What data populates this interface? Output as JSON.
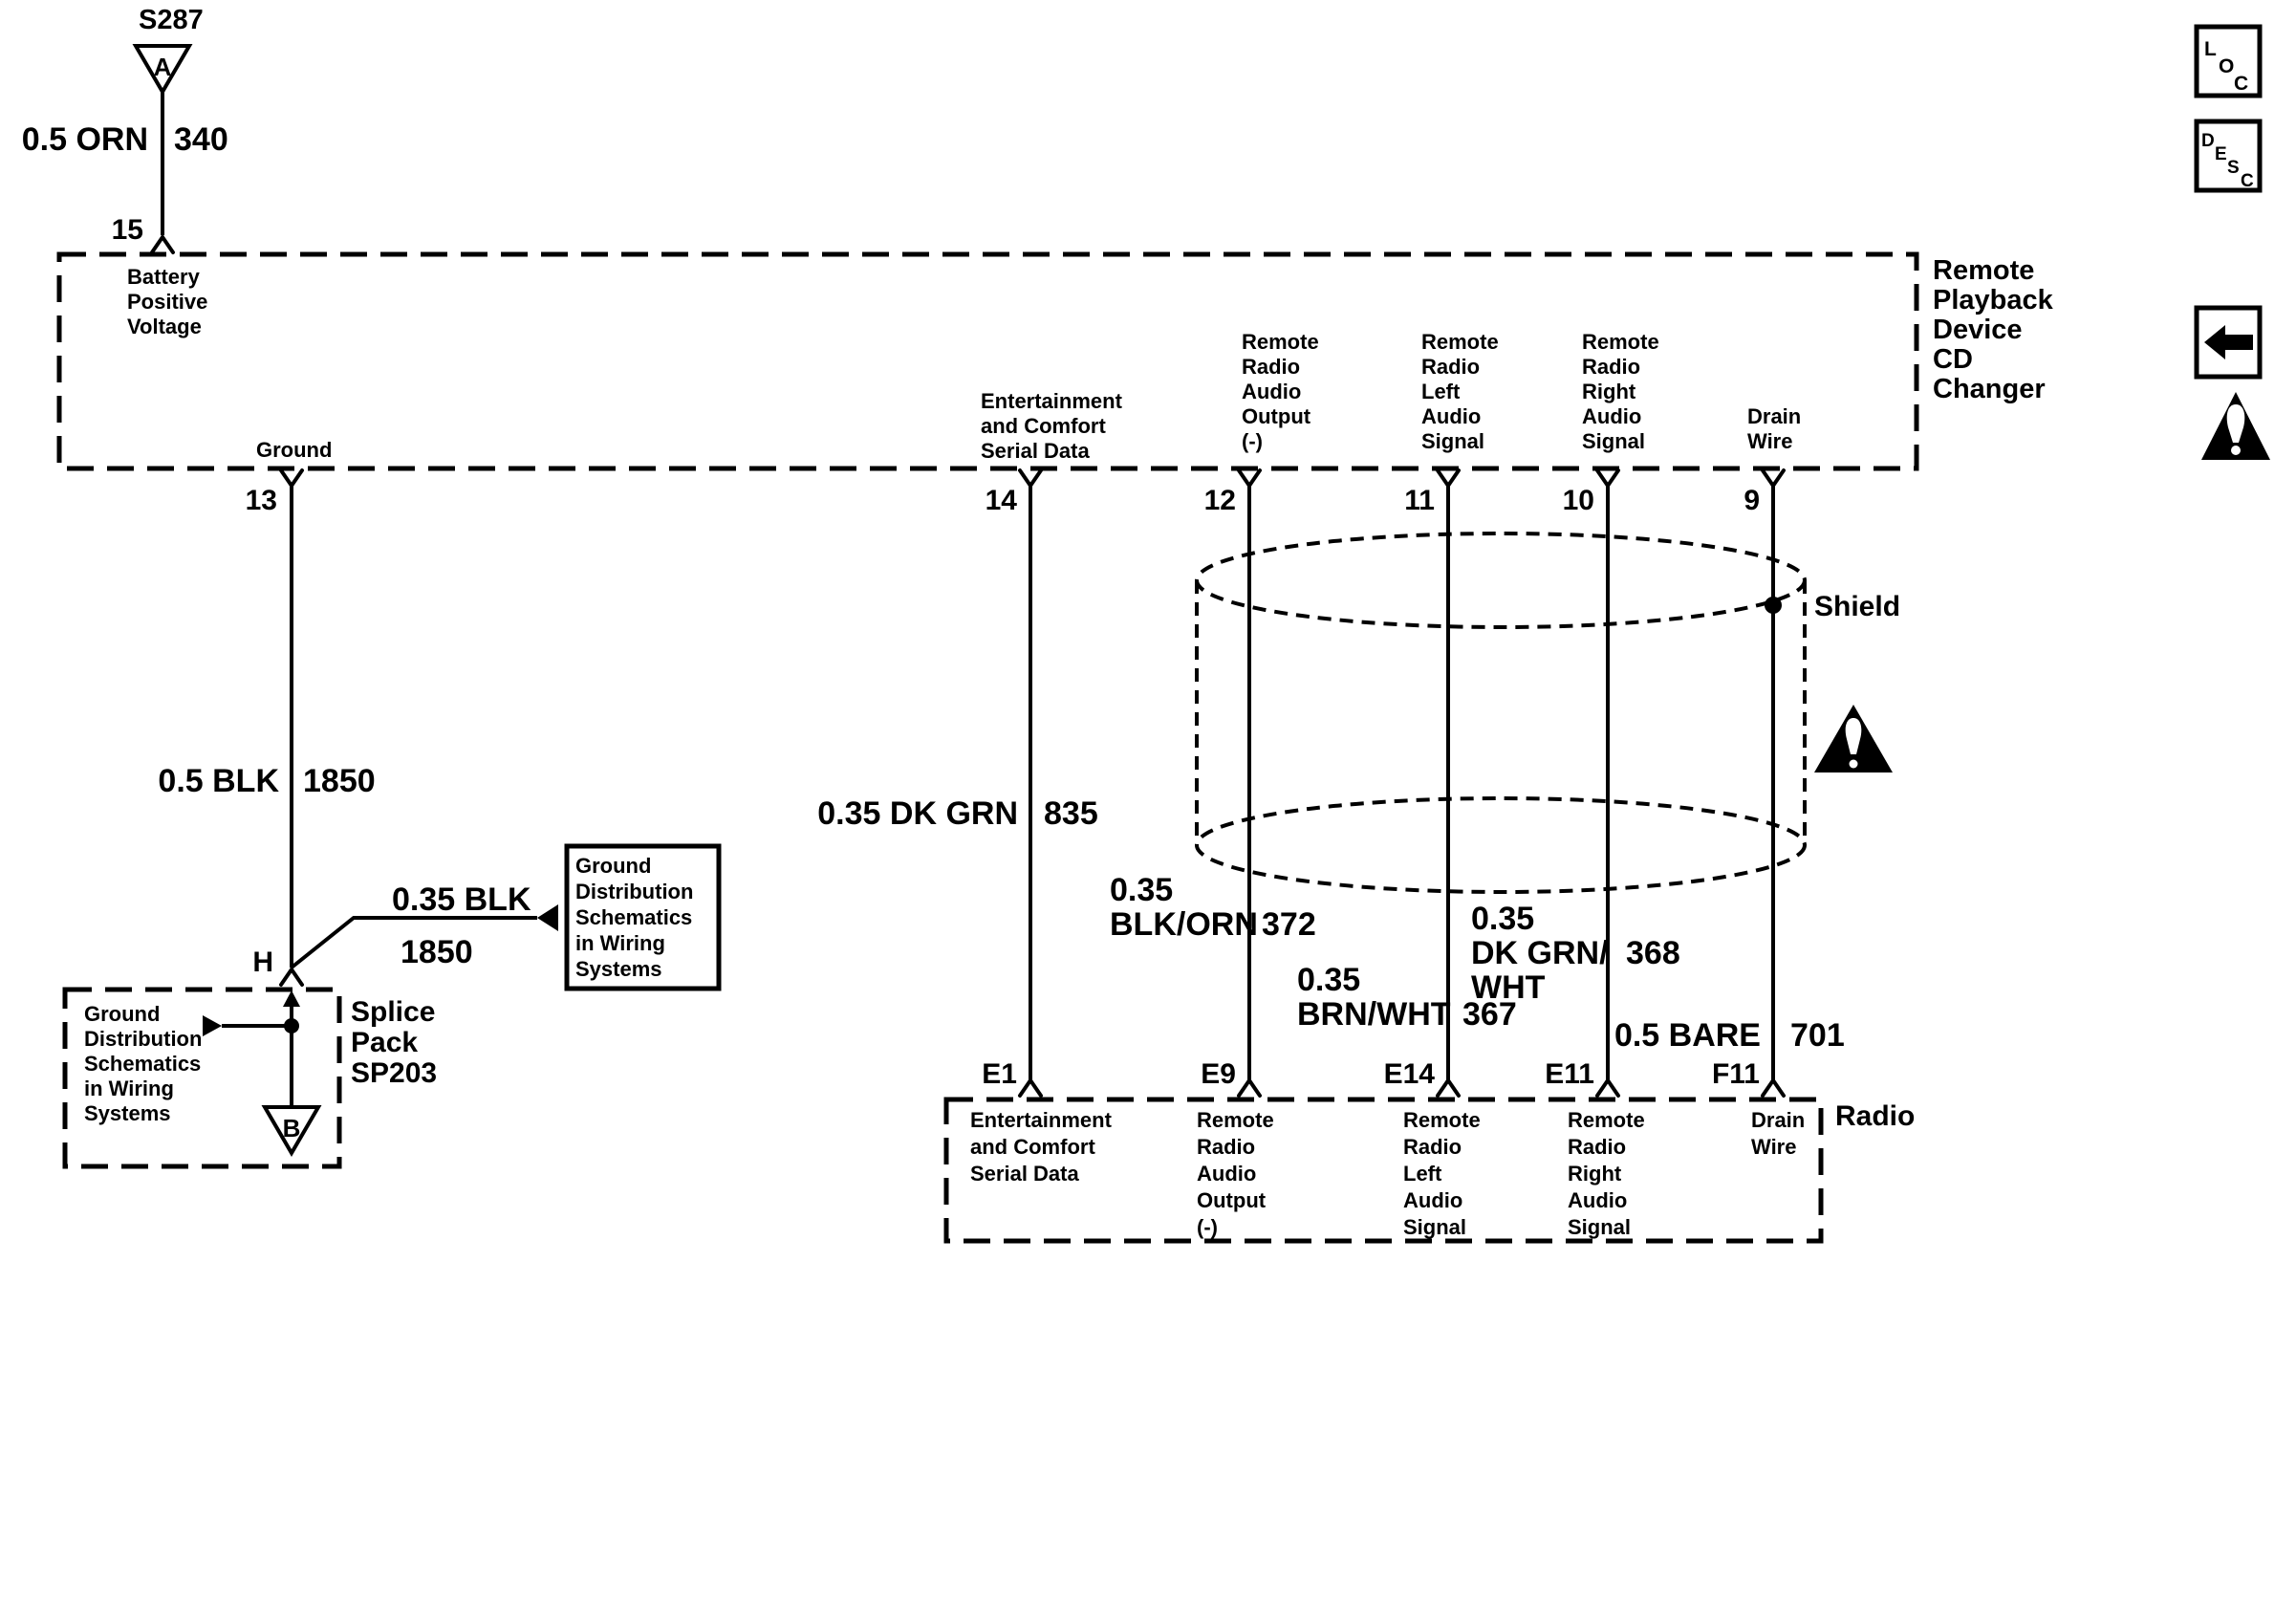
{
  "colors": {
    "ink": "#000000",
    "background": "#ffffff"
  },
  "s287": {
    "id": "S287",
    "connector_letter": "A",
    "wire_color": "0.5 ORN",
    "circuit_number": "340",
    "pin": "15"
  },
  "cd_changer": {
    "name_lines": [
      "Remote",
      "Playback",
      "Device",
      "CD",
      "Changer"
    ],
    "battery_lines": [
      "Battery",
      "Positive",
      "Voltage"
    ],
    "pins": {
      "ground": {
        "number": "13",
        "label": "Ground"
      },
      "serial": {
        "number": "14",
        "lines": [
          "Entertainment",
          "and Comfort",
          "Serial Data"
        ]
      },
      "audio_out": {
        "number": "12",
        "lines": [
          "Remote",
          "Radio",
          "Audio",
          "Output",
          "(-)"
        ]
      },
      "left_audio": {
        "number": "11",
        "lines": [
          "Remote",
          "Radio",
          "Left",
          "Audio",
          "Signal"
        ]
      },
      "right_audio": {
        "number": "10",
        "lines": [
          "Remote",
          "Radio",
          "Right",
          "Audio",
          "Signal"
        ]
      },
      "drain": {
        "number": "9",
        "lines": [
          "Drain",
          "Wire"
        ]
      }
    }
  },
  "wires": {
    "ground": {
      "color": "0.5 BLK",
      "circuit": "1850"
    },
    "splice_branch": {
      "color": "0.35 BLK",
      "circuit": "1850"
    },
    "serial": {
      "color": "0.35 DK GRN",
      "circuit": "835"
    },
    "audio_out": {
      "color_lines": [
        "0.35",
        "BLK/ORN"
      ],
      "circuit": "372"
    },
    "left_audio": {
      "color_lines": [
        "0.35",
        "BRN/WHT"
      ],
      "circuit": "367"
    },
    "right_audio": {
      "color_lines": [
        "0.35",
        "DK GRN/",
        "WHT"
      ],
      "circuit": "368"
    },
    "drain": {
      "color": "0.5 BARE",
      "circuit": "701"
    }
  },
  "splice": {
    "pin": "H",
    "connector_letter": "B",
    "pack_lines": [
      "Splice",
      "Pack",
      "SP203"
    ],
    "dashed_box_lines": [
      "Ground",
      "Distribution",
      "Schematics",
      "in Wiring",
      "Systems"
    ]
  },
  "ground_distribution_box_lines": [
    "Ground",
    "Distribution",
    "Schematics",
    "in Wiring",
    "Systems"
  ],
  "shield": {
    "label": "Shield"
  },
  "radio": {
    "name": "Radio",
    "pins": {
      "serial": {
        "number": "E1",
        "lines": [
          "Entertainment",
          "and Comfort",
          "Serial Data"
        ]
      },
      "audio_out": {
        "number": "E9",
        "lines": [
          "Remote",
          "Radio",
          "Audio",
          "Output",
          "(-)"
        ]
      },
      "left_audio": {
        "number": "E14",
        "lines": [
          "Remote",
          "Radio",
          "Left",
          "Audio",
          "Signal"
        ]
      },
      "right_audio": {
        "number": "E11",
        "lines": [
          "Remote",
          "Radio",
          "Right",
          "Audio",
          "Signal"
        ]
      },
      "drain": {
        "number": "F11",
        "lines": [
          "Drain",
          "Wire"
        ]
      }
    }
  },
  "corner_icons": {
    "loc_letters": [
      "L",
      "O",
      "C"
    ],
    "desc_letters": [
      "D",
      "E",
      "S",
      "C"
    ]
  }
}
